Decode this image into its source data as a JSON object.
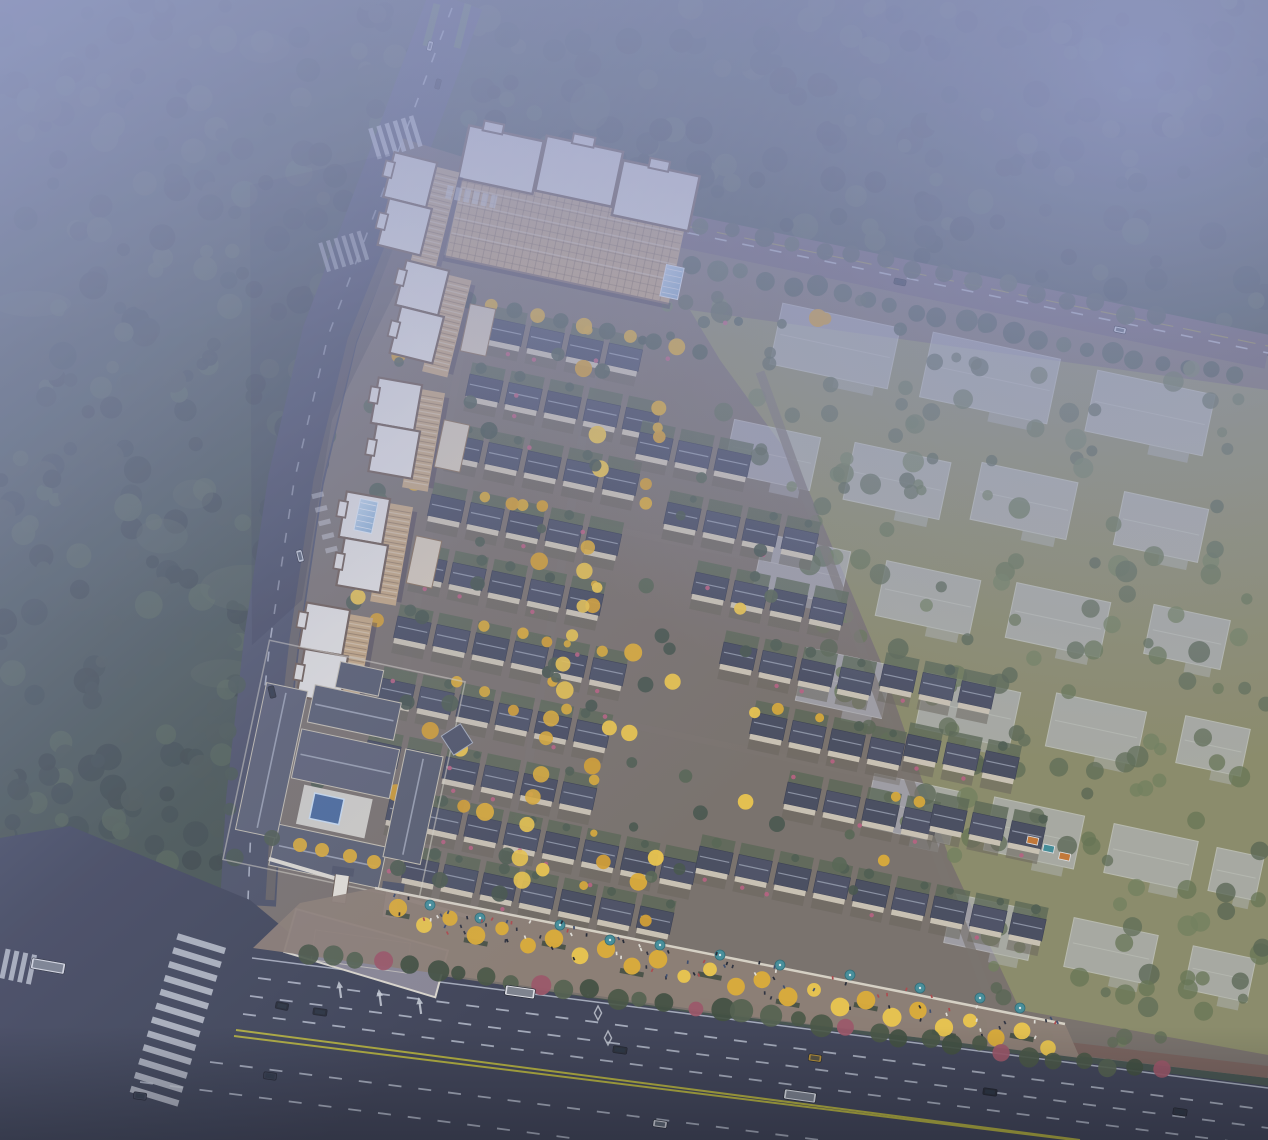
{
  "scene": {
    "description": "Dusk aerial rendering of a residential development: high-rise slab towers along a western road, a large mid-rise block to the north, dense rows of dark-roofed townhouses with autumn ginkgo trees, a Chinese-style courtyard clubhouse and south entrance gate, a tree-lined pedestrian promenade with teal umbrellas and crowds along a wide multi-lane boulevard, and translucent massing models of a future phase on olive grass to the east; foggy forest wraps the north and west.",
    "palette": {
      "forest-base": "#45524a",
      "forest-tones": [
        "#3d4943",
        "#465349",
        "#50604d",
        "#3a443f"
      ],
      "fog": "#9aa2cc",
      "site-ground": "#7a7169",
      "grass": "#8e8e66",
      "asphalt": "#3e4254",
      "asphalt2": "#4b4f61",
      "ne-road": "#6d6168",
      "lane-white": "#ccd1dd",
      "lane-yellow": "#b6b138",
      "roof-dark": "#4c5062",
      "roof-dark2": "#474b5c",
      "roof-ridge": "#8d93a2",
      "wall-cream": "#cfc6b3",
      "tower-wall": "#c8a87d",
      "tower-roof": "#ebe8e2",
      "parapet": "#6f5b4c",
      "ghost": "#c9cede",
      "tree-yellow": "#e2ae32",
      "tree-yellow2": "#f2c948",
      "tree-green": "#4e5c4d",
      "shrub-pink": "#bd5f7e",
      "umbrella-teal": "#44909a",
      "pavement": "#8f7e72",
      "wall-white": "#e6e1d4",
      "glass-blue": "#a9c7de"
    }
  },
  "render": {
    "towers": [
      {
        "x": 412,
        "y": 206
      },
      {
        "x": 424,
        "y": 314
      },
      {
        "x": 400,
        "y": 430
      },
      {
        "x": 368,
        "y": 544
      },
      {
        "x": 328,
        "y": 655
      }
    ],
    "podiums": [
      {
        "x": 478,
        "y": 330
      },
      {
        "x": 452,
        "y": 446
      },
      {
        "x": 424,
        "y": 562
      }
    ],
    "townhouse_rows": [
      {
        "x": 492,
        "y": 318,
        "n": 4
      },
      {
        "x": 470,
        "y": 374,
        "n": 5
      },
      {
        "x": 450,
        "y": 434,
        "n": 5
      },
      {
        "x": 432,
        "y": 494,
        "n": 5
      },
      {
        "x": 414,
        "y": 554,
        "n": 5
      },
      {
        "x": 398,
        "y": 616,
        "n": 6
      },
      {
        "x": 382,
        "y": 678,
        "n": 6
      },
      {
        "x": 368,
        "y": 740,
        "n": 6
      },
      {
        "x": 640,
        "y": 432,
        "n": 3
      },
      {
        "x": 668,
        "y": 502,
        "n": 4
      },
      {
        "x": 696,
        "y": 572,
        "n": 4
      },
      {
        "x": 724,
        "y": 642,
        "n": 4
      },
      {
        "x": 754,
        "y": 712,
        "n": 4
      },
      {
        "x": 788,
        "y": 782,
        "n": 4
      },
      {
        "x": 884,
        "y": 664,
        "n": 3
      },
      {
        "x": 908,
        "y": 734,
        "n": 3
      },
      {
        "x": 934,
        "y": 804,
        "n": 3
      },
      {
        "x": 390,
        "y": 798,
        "n": 8
      },
      {
        "x": 700,
        "y": 846,
        "n": 9
      },
      {
        "x": 406,
        "y": 856,
        "n": 7
      }
    ],
    "ghost_buildings": [
      {
        "x": 775,
        "y": 315,
        "w": 120,
        "h": 62
      },
      {
        "x": 925,
        "y": 345,
        "w": 130,
        "h": 66
      },
      {
        "x": 1090,
        "y": 382,
        "w": 120,
        "h": 62
      },
      {
        "x": 728,
        "y": 428,
        "w": 88,
        "h": 54
      },
      {
        "x": 848,
        "y": 452,
        "w": 98,
        "h": 58
      },
      {
        "x": 975,
        "y": 472,
        "w": 98,
        "h": 58
      },
      {
        "x": 1118,
        "y": 500,
        "w": 86,
        "h": 54
      },
      {
        "x": 758,
        "y": 542,
        "w": 88,
        "h": 54
      },
      {
        "x": 880,
        "y": 570,
        "w": 96,
        "h": 56
      },
      {
        "x": 1010,
        "y": 592,
        "w": 96,
        "h": 56
      },
      {
        "x": 1148,
        "y": 612,
        "w": 78,
        "h": 50
      },
      {
        "x": 800,
        "y": 656,
        "w": 88,
        "h": 54
      },
      {
        "x": 920,
        "y": 682,
        "w": 96,
        "h": 56
      },
      {
        "x": 1050,
        "y": 702,
        "w": 92,
        "h": 54
      },
      {
        "x": 1180,
        "y": 722,
        "w": 66,
        "h": 48
      },
      {
        "x": 868,
        "y": 782,
        "w": 88,
        "h": 54
      },
      {
        "x": 988,
        "y": 806,
        "w": 92,
        "h": 54
      },
      {
        "x": 1108,
        "y": 832,
        "w": 86,
        "h": 50
      },
      {
        "x": 1212,
        "y": 852,
        "w": 48,
        "h": 44
      },
      {
        "x": 948,
        "y": 902,
        "w": 86,
        "h": 50
      },
      {
        "x": 1068,
        "y": 926,
        "w": 86,
        "h": 50
      },
      {
        "x": 1188,
        "y": 952,
        "w": 64,
        "h": 44
      }
    ],
    "spine_trees": {
      "x1": 592,
      "y1": 548,
      "x2": 518,
      "y2": 882,
      "n": 13
    },
    "promenade": {
      "trees": {
        "x1": 398,
        "y1": 912,
        "x2": 1048,
        "y2": 1040,
        "n": 26
      },
      "umbrellas": [
        [
          430,
          905
        ],
        [
          480,
          918
        ],
        [
          560,
          925
        ],
        [
          610,
          940
        ],
        [
          660,
          945
        ],
        [
          720,
          955
        ],
        [
          780,
          965
        ],
        [
          850,
          975
        ],
        [
          920,
          988
        ],
        [
          980,
          998
        ],
        [
          1020,
          1008
        ]
      ],
      "people_count": 85,
      "shrubs": {
        "x1": 305,
        "y1": 952,
        "x2": 1160,
        "y2": 1072,
        "n": 34
      }
    },
    "vehicles": [
      {
        "x": 520,
        "y": 992,
        "l": 30,
        "w": 10,
        "c": "#e6e6ea",
        "r": 8,
        "kind": "bus"
      },
      {
        "x": 800,
        "y": 1096,
        "l": 32,
        "w": 10,
        "c": "#dfe2e8",
        "r": 8,
        "kind": "bus"
      },
      {
        "x": 48,
        "y": 966,
        "l": 34,
        "w": 11,
        "c": "#e4e6ea",
        "r": 10,
        "kind": "bus"
      },
      {
        "x": 320,
        "y": 1012,
        "l": 14,
        "w": 7,
        "c": "#23262f",
        "r": 8,
        "kind": "car"
      },
      {
        "x": 620,
        "y": 1050,
        "l": 14,
        "w": 7,
        "c": "#2a2d36",
        "r": 8,
        "kind": "car"
      },
      {
        "x": 815,
        "y": 1058,
        "l": 13,
        "w": 7,
        "c": "#b89030",
        "r": 8,
        "kind": "car"
      },
      {
        "x": 990,
        "y": 1092,
        "l": 14,
        "w": 7,
        "c": "#23262f",
        "r": 8,
        "kind": "car"
      },
      {
        "x": 1180,
        "y": 1112,
        "l": 14,
        "w": 7,
        "c": "#2e313c",
        "r": 8,
        "kind": "car"
      },
      {
        "x": 270,
        "y": 1076,
        "l": 13,
        "w": 7,
        "c": "#343848",
        "r": 8,
        "kind": "car"
      },
      {
        "x": 140,
        "y": 1096,
        "l": 13,
        "w": 7,
        "c": "#3c4050",
        "r": 188,
        "kind": "car"
      },
      {
        "x": 660,
        "y": 1124,
        "l": 14,
        "w": 7,
        "c": "#d8dae0",
        "r": 8,
        "kind": "car"
      },
      {
        "x": 282,
        "y": 1006,
        "l": 13,
        "w": 7,
        "c": "#22252e",
        "r": 12,
        "kind": "car"
      },
      {
        "x": 300,
        "y": 556,
        "l": 12,
        "w": 6,
        "c": "#d0d4da",
        "r": 76,
        "kind": "car"
      },
      {
        "x": 272,
        "y": 692,
        "l": 12,
        "w": 6,
        "c": "#2c3038",
        "r": 76,
        "kind": "car"
      },
      {
        "x": 430,
        "y": 46,
        "l": 10,
        "w": 5,
        "c": "#d8dce2",
        "r": -76,
        "kind": "car"
      },
      {
        "x": 438,
        "y": 84,
        "l": 10,
        "w": 5,
        "c": "#2e323e",
        "r": -76,
        "kind": "car"
      },
      {
        "x": 900,
        "y": 282,
        "l": 12,
        "w": 6,
        "c": "#32363e",
        "r": 12,
        "kind": "car"
      },
      {
        "x": 1120,
        "y": 330,
        "l": 12,
        "w": 6,
        "c": "#d4d8de",
        "r": 12,
        "kind": "car"
      }
    ],
    "canopies": [
      [
        672,
        282
      ],
      [
        366,
        516
      ]
    ],
    "construction_boards": [
      [
        1028,
        836
      ],
      [
        1044,
        844
      ],
      [
        1060,
        852
      ]
    ],
    "forest": {
      "attempts": 1500,
      "seed": 7
    },
    "scatter": {
      "yellow": 46,
      "green": 55,
      "pink": 26,
      "grass_trees": 70
    }
  }
}
